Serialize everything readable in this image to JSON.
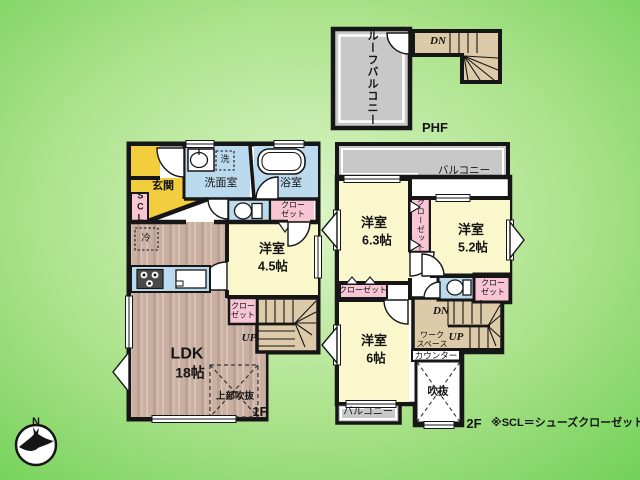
{
  "labels": {
    "phf_roof_balcony": "ルーフバルコニー",
    "phf_dn": "DN",
    "phf_floor": "PHF",
    "f1_genkan": "玄関",
    "f1_scl": "SCL",
    "f1_washroom": "洗面室",
    "f1_washer": "洗",
    "f1_bathroom": "浴室",
    "f1_closet_a_l1": "クロー",
    "f1_closet_a_l2": "ゼット",
    "f1_room45_name": "洋室",
    "f1_room45_size": "4.5帖",
    "f1_fridge": "冷",
    "f1_ldk_name": "LDK",
    "f1_ldk_size": "18帖",
    "f1_closet_b_l1": "クロー",
    "f1_closet_b_l2": "ゼット",
    "f1_up": "UP",
    "f1_void_upper": "上部吹抜",
    "f1_floor": "1F",
    "f2_balcony_top": "バルコニー",
    "f2_room63_name": "洋室",
    "f2_room63_size": "6.3帖",
    "f2_closet_vertical": "クローゼット",
    "f2_room52_name": "洋室",
    "f2_room52_size": "5.2帖",
    "f2_closet_left": "クローゼット",
    "f2_closet_right_l1": "クロー",
    "f2_closet_right_l2": "ゼット",
    "f2_dn": "DN",
    "f2_up": "UP",
    "f2_workspace_l1": "ワーク",
    "f2_workspace_l2": "スペース",
    "f2_counter": "カウンター",
    "f2_room6_name": "洋室",
    "f2_room6_size": "6帖",
    "f2_void": "吹抜",
    "f2_balcony_bottom": "バルコニー",
    "f2_floor": "2F",
    "note": "※SCL＝シューズクローゼット",
    "compass_n": "N"
  },
  "colors": {
    "background_edge": "#6ed054",
    "background_center": "#ddf5c8",
    "wall": "#161616",
    "room_yellow": "#fbf7cd",
    "accent_gold": "#f2cd3e",
    "closet_pink": "#f8c5d4",
    "water_blue": "#bcdaee",
    "balcony_gray": "#c8c8c8",
    "stair_tan": "#dccaa8",
    "wood_floor": "#cab0a2"
  }
}
